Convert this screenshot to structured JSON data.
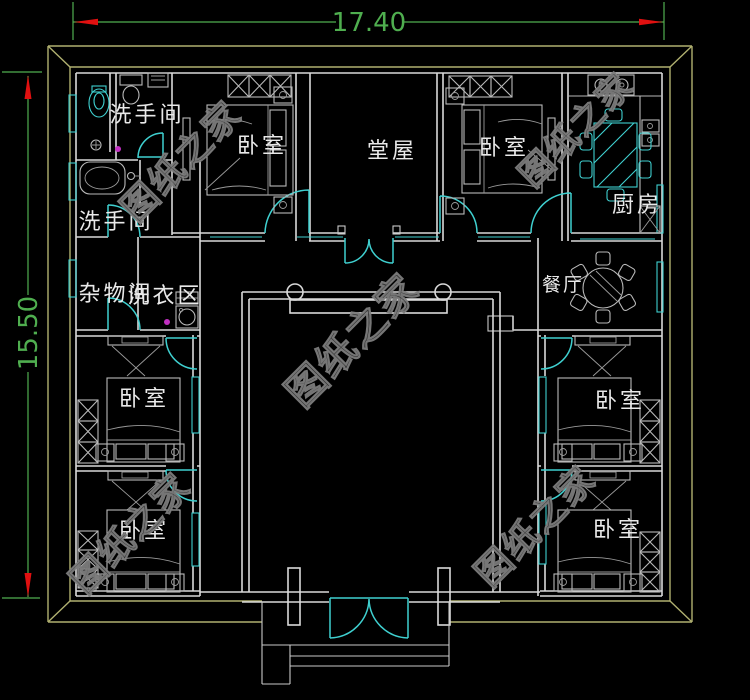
{
  "plan": {
    "rooms": {
      "washroom_top": "洗手间",
      "washroom_left": "洗手间",
      "storage": "杂物间",
      "laundry": "洗衣区",
      "bedroom": "卧室",
      "hall": "堂屋",
      "kitchen": "厨房",
      "dining": "餐厅"
    },
    "dimensions": {
      "width": "17.40",
      "height": "15.50"
    },
    "watermark": "图纸之家",
    "colors": {
      "background": "#000000",
      "walls": "#d9d9d9",
      "doors_windows": "#3fd0d0",
      "dimension_line": "#4fae4f",
      "dimension_arrow": "#e01010",
      "outer_boundary": "#b0b070",
      "room_label": "#e9e9e9",
      "watermark": "#4a4a4a",
      "marker_dot": "#c230c2"
    }
  }
}
